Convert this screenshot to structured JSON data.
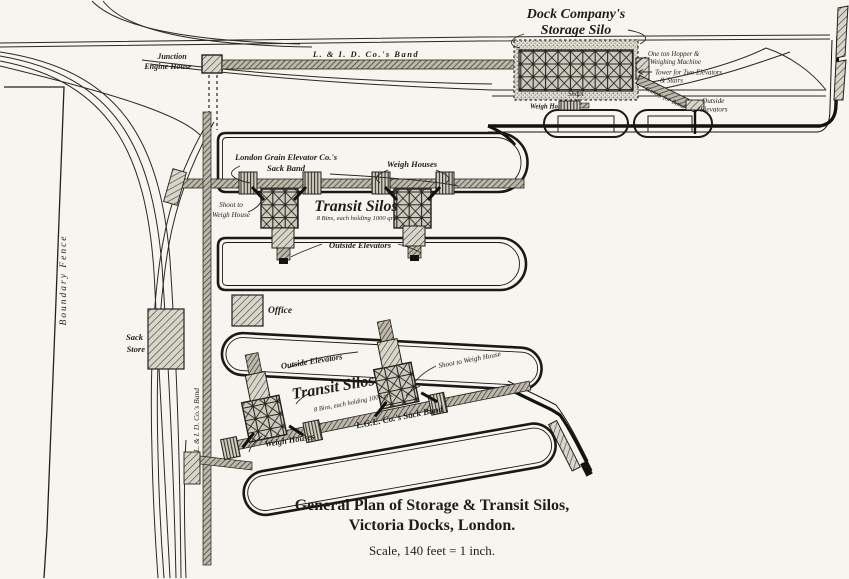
{
  "page": {
    "kind": "engraved plan",
    "paper_color": "#f6f5f0",
    "ink_color": "#1f1d19"
  },
  "title": {
    "line1": "General Plan of Storage & Transit Silos,",
    "line2": "Victoria Docks, London.",
    "scale_note": "Scale, 140 feet = 1 inch."
  },
  "labels": {
    "dock_company_line1": "Dock Company's",
    "dock_company_line2": "Storage Silo",
    "lid_band_horizontal": "L. & I. D. Co.'s Band",
    "junction_line1": "Junction",
    "junction_line2": "Engine House",
    "hopper_line1": "One ton Hopper &",
    "hopper_line2": "Weighing Machine",
    "tower_line1": "Tower for Two Elevators",
    "tower_line2": "& Stairs",
    "gantry": "Gantry for Band",
    "outside_elevators_top_line1": "Outside",
    "outside_elevators_top_line2": "Elevators",
    "shoot": "Shoot",
    "weigh_house_abbrev": "Weigh Ho.",
    "grain_band_line1": "London Grain Elevator Co.'s",
    "grain_band_line2": "Sack Band",
    "weigh_houses_top": "Weigh Houses",
    "transit_silos_top": "Transit Silos",
    "bins_top": "8 Bins, each holding 1000 qrs.",
    "shoot_to_line1": "Shoot to",
    "shoot_to_line2": "Weigh House",
    "outside_elevators_mid": "Outside Elevators",
    "office": "Office",
    "sack_store_line1": "Sack",
    "sack_store_line2": "Store",
    "boundary_fence": "Boundary Fence",
    "lid_band_vertical": "L. & I. D. Co.'s Band",
    "outside_elevators_bottom": "Outside Elevators",
    "transit_silos_bottom": "Transit Silos",
    "bins_bottom": "8 Bins, each holding 1000 qrs.",
    "shoot_to_weigh_house_bottom": "Shoot to Weigh House",
    "lge_sack_band": "L.G.E. Co.'s Sack Band",
    "weigh_houses_bottom": "Weigh Houses"
  }
}
